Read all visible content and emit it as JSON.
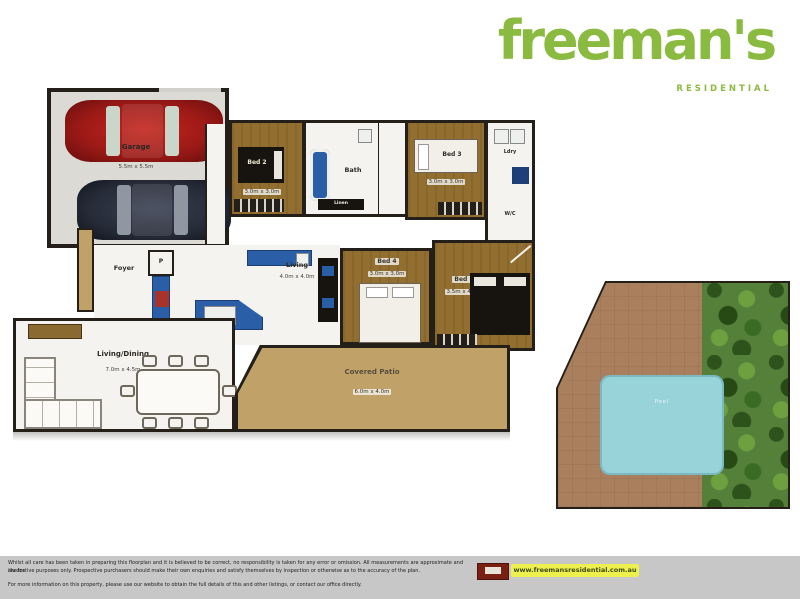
{
  "brand": {
    "wordmark": "freeman's",
    "tagline": "RESIDENTIAL",
    "green": "#8bba41"
  },
  "floorplan": {
    "garage": {
      "label": "Garage",
      "dims": "5.5m x 5.5m"
    },
    "bed2": {
      "label": "Bed 2",
      "dims": "3.0m x 3.0m"
    },
    "bath": {
      "label": "Bath"
    },
    "linen": {
      "label": "Linen"
    },
    "bed3": {
      "label": "Bed 3",
      "dims": "3.0m x 3.0m"
    },
    "laundry": {
      "label": "Ldry"
    },
    "wc": {
      "label": "W/C"
    },
    "foyer": {
      "label": "Foyer"
    },
    "pantry": {
      "label": "P"
    },
    "living": {
      "label": "Living",
      "dims": "4.0m x 4.0m"
    },
    "bed4": {
      "label": "Bed 4",
      "dims": "3.0m x 3.0m"
    },
    "bed1": {
      "label": "Bed 1",
      "dims": "3.5m x 4.0m"
    },
    "living_dining": {
      "label": "Living/Dining",
      "dims": "7.0m x 4.5m"
    },
    "patio": {
      "label": "Covered Patio",
      "dims": "6.0m x 4.0m"
    }
  },
  "pool_area": {
    "pool_label": "Pool"
  },
  "footer": {
    "disclaimer_line1": "Whilst all care has been taken in preparing this floorplan and it is believed to be correct, no responsibility is taken for any error or omission. All measurements are approximate and are for",
    "disclaimer_line2": "illustrative purposes only. Prospective purchasers should make their own enquiries and satisfy themselves by inspection or otherwise as to the accuracy of the plan.",
    "disclaimer_line3": "For more information on this property, please use our website to obtain the full details of this and other listings, or contact our office directly.",
    "website": "www.freemansresidential.com.au"
  },
  "colors": {
    "brand_green": "#8bba41",
    "timber_brown": "#926f30",
    "patio_tan": "#c0a269",
    "kitchen_blue": "#2a5fa8",
    "pool_blue": "#98d3da",
    "highlight_yellow": "#eef04e"
  }
}
